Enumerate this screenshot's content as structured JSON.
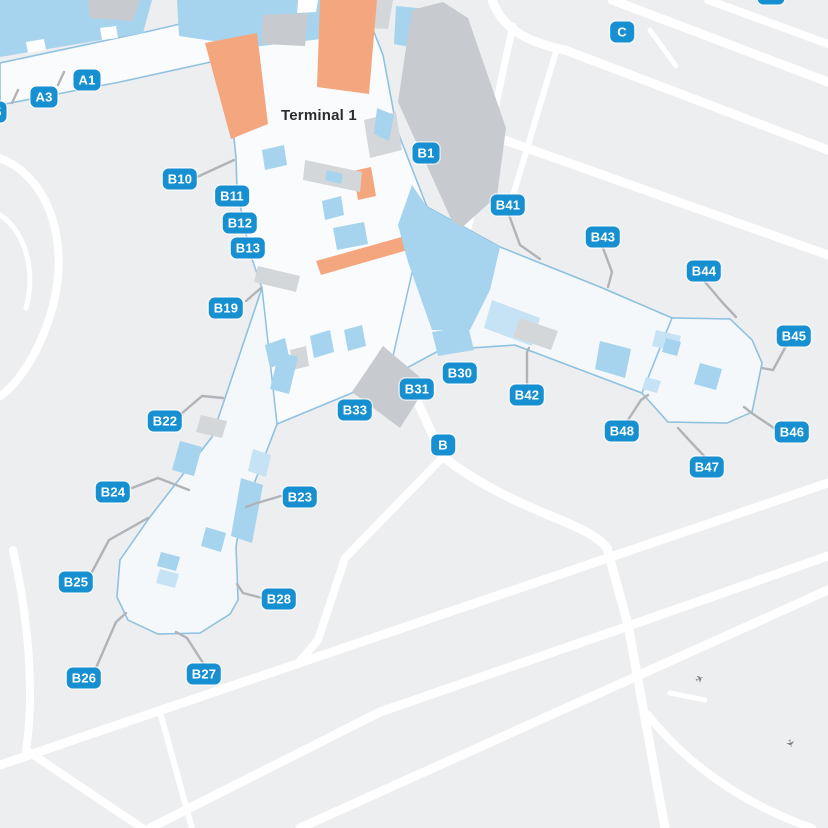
{
  "terminal_title": "Terminal 1",
  "colors": {
    "land_gray": "#edeef0",
    "apron_white": "#fafbfd",
    "pier_white": "#f4f8fb",
    "boundary_blue": "#8fc2e1",
    "road_white": "#ffffff",
    "building_gray_dark": "#c7cace",
    "building_gray_mid": "#d4d7da",
    "room_blue": "#a6d4ee",
    "room_blue_light": "#c5e3f5",
    "highlight_orange": "#f4a77e",
    "label_blue": "#1790d2",
    "leader_gray": "#b0b3b7",
    "title_color": "#2a2c2e"
  },
  "gates": [
    {
      "id": "A5",
      "x": -7,
      "y": 112
    },
    {
      "id": "A3",
      "x": 44,
      "y": 97
    },
    {
      "id": "A1",
      "x": 87,
      "y": 80
    },
    {
      "id": "B10",
      "x": 180,
      "y": 179
    },
    {
      "id": "B11",
      "x": 232,
      "y": 196
    },
    {
      "id": "B12",
      "x": 240,
      "y": 223
    },
    {
      "id": "B13",
      "x": 248,
      "y": 248
    },
    {
      "id": "B19",
      "x": 226,
      "y": 308
    },
    {
      "id": "B22",
      "x": 165,
      "y": 421
    },
    {
      "id": "B24",
      "x": 113,
      "y": 492
    },
    {
      "id": "B25",
      "x": 76,
      "y": 582
    },
    {
      "id": "B26",
      "x": 84,
      "y": 678
    },
    {
      "id": "B27",
      "x": 204,
      "y": 674
    },
    {
      "id": "B28",
      "x": 279,
      "y": 599
    },
    {
      "id": "B23",
      "x": 300,
      "y": 497
    },
    {
      "id": "B33",
      "x": 355,
      "y": 410
    },
    {
      "id": "B31",
      "x": 417,
      "y": 389
    },
    {
      "id": "B30",
      "x": 460,
      "y": 373
    },
    {
      "id": "B",
      "x": 443,
      "y": 445
    },
    {
      "id": "B42",
      "x": 527,
      "y": 395
    },
    {
      "id": "B41",
      "x": 508,
      "y": 205
    },
    {
      "id": "B1",
      "x": 426,
      "y": 153
    },
    {
      "id": "B43",
      "x": 603,
      "y": 237
    },
    {
      "id": "B44",
      "x": 704,
      "y": 271
    },
    {
      "id": "B45",
      "x": 794,
      "y": 336
    },
    {
      "id": "B46",
      "x": 792,
      "y": 432
    },
    {
      "id": "B47",
      "x": 707,
      "y": 467
    },
    {
      "id": "B48",
      "x": 622,
      "y": 431
    },
    {
      "id": "C",
      "x": 622,
      "y": 32
    },
    {
      "id": "C6",
      "x": 771,
      "y": -6
    }
  ]
}
